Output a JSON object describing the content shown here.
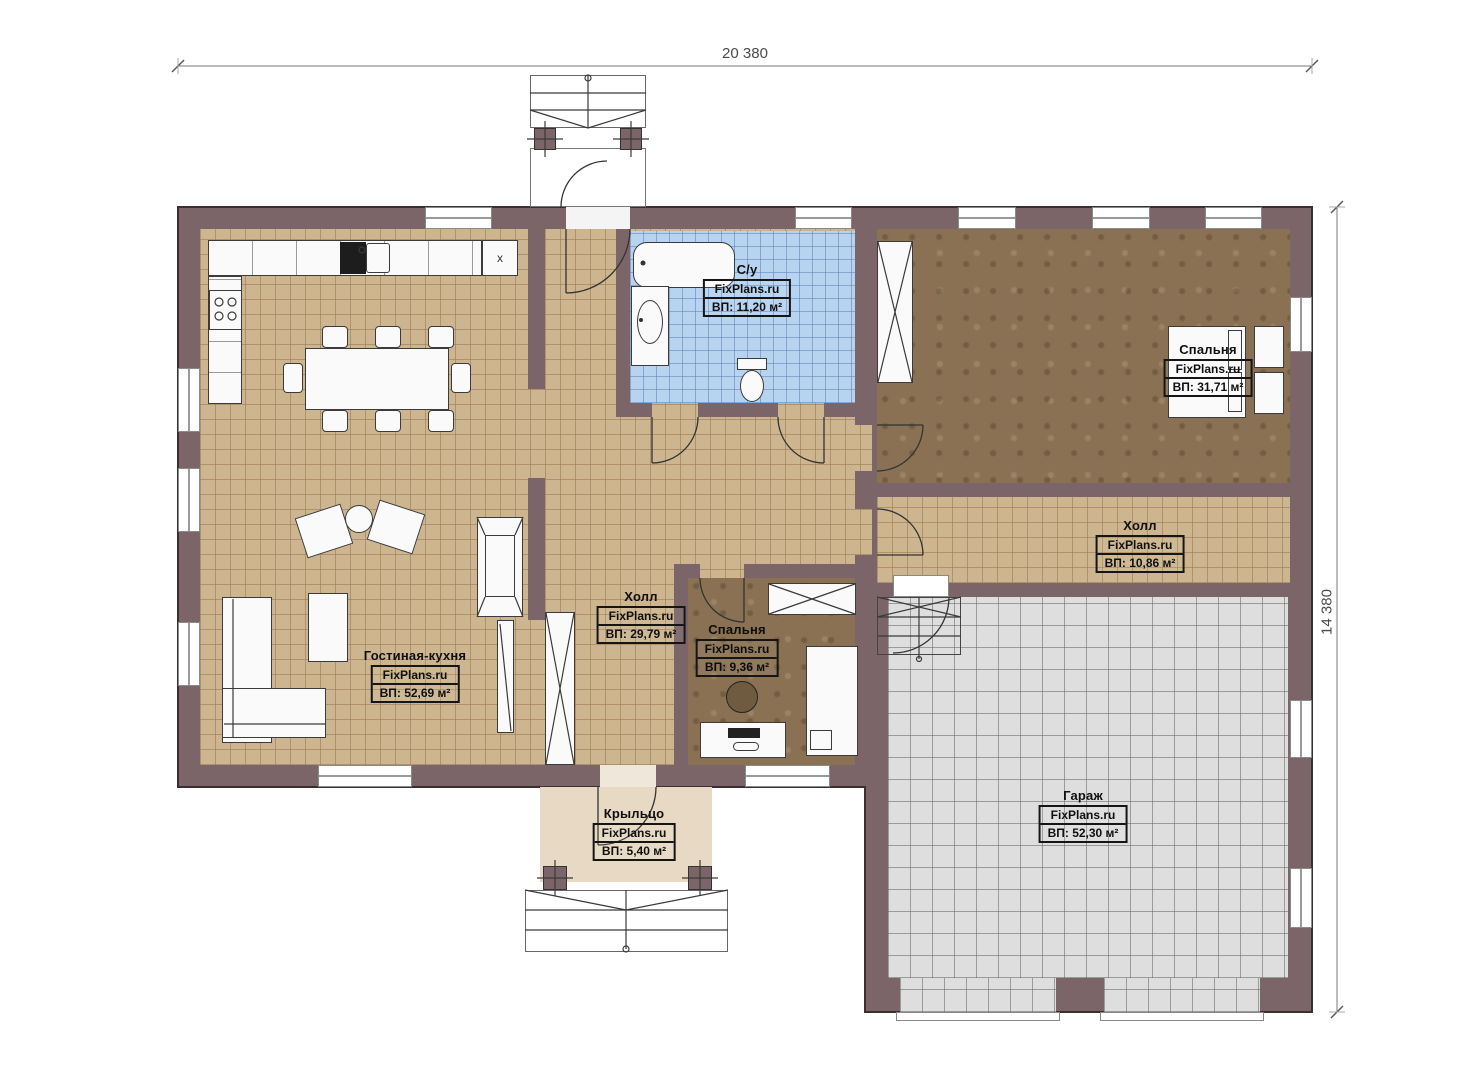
{
  "dimensions": {
    "width_label": "20 380",
    "height_label": "14 380"
  },
  "rooms": [
    {
      "name": "С/у",
      "brand": "FixPlans.ru",
      "area": "ВП: 11,20 м²"
    },
    {
      "name": "Спальня",
      "brand": "FixPlans.ru",
      "area": "ВП: 31,71 м²"
    },
    {
      "name": "Холл",
      "brand": "FixPlans.ru",
      "area": "ВП: 10,86 м²"
    },
    {
      "name": "Холл",
      "brand": "FixPlans.ru",
      "area": "ВП: 29,79 м²"
    },
    {
      "name": "Спальня",
      "brand": "FixPlans.ru",
      "area": "ВП: 9,36 м²"
    },
    {
      "name": "Гостиная-кухня",
      "brand": "FixPlans.ru",
      "area": "ВП: 52,69 м²"
    },
    {
      "name": "Крыльцо",
      "brand": "FixPlans.ru",
      "area": "ВП: 5,40 м²"
    },
    {
      "name": "Гараж",
      "brand": "FixPlans.ru",
      "area": "ВП: 52,30 м²"
    }
  ],
  "markers": {
    "kitchen_cabinet": "x"
  },
  "colors": {
    "wall": "#7b6568",
    "floor_tile": "#cdb58f",
    "floor_bath": "#b7d3f0",
    "floor_bedroom": "#8a7153",
    "floor_garage": "#dedede",
    "floor_porch": "#e7d9c3"
  }
}
